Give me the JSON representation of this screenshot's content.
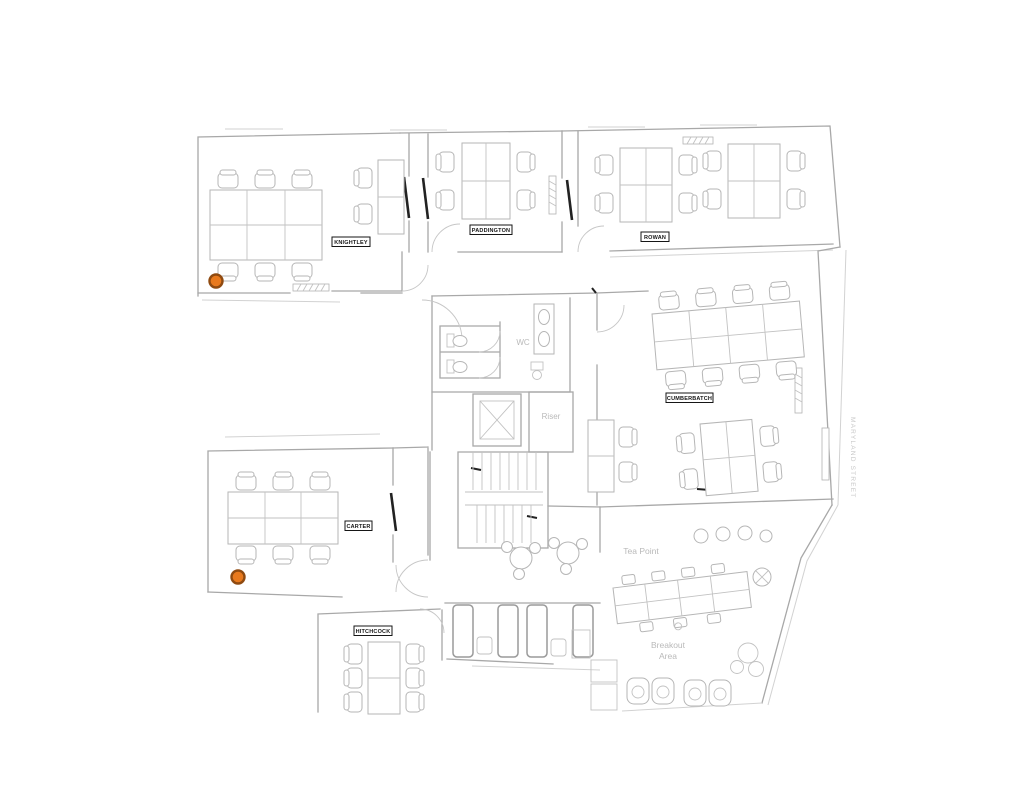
{
  "floorplan": {
    "rooms": [
      {
        "id": "knightley",
        "label": "KNIGHTLEY"
      },
      {
        "id": "paddington",
        "label": "PADDINGTON"
      },
      {
        "id": "rowan",
        "label": "ROWAN"
      },
      {
        "id": "cumberbatch",
        "label": "CUMBERBATCH"
      },
      {
        "id": "carter",
        "label": "CARTER"
      },
      {
        "id": "hitchcock",
        "label": "HITCHCOCK"
      }
    ],
    "areas": {
      "wc": "WC",
      "riser": "Riser",
      "tea_point": "Tea Point",
      "breakout_line1": "Breakout",
      "breakout_line2": "Area"
    },
    "street_label": "MARYLAND STREET",
    "markers": [
      {
        "x": 216,
        "y": 281
      },
      {
        "x": 238,
        "y": 577
      }
    ],
    "colors": {
      "marker_fill": "#E8791D",
      "marker_stroke": "#8F4A10"
    }
  }
}
